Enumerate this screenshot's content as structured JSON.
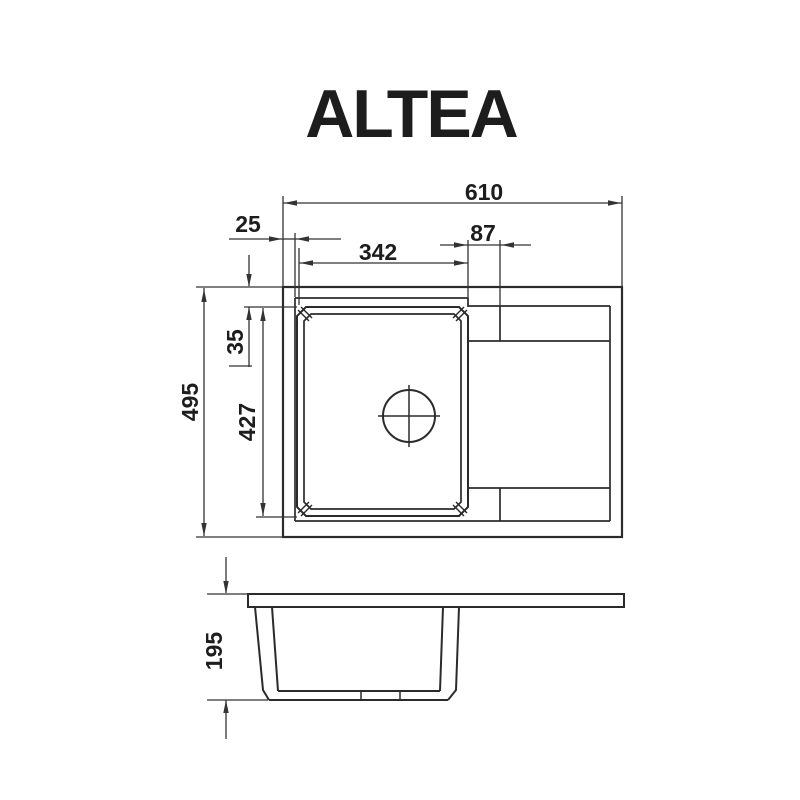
{
  "title": "ALTEA",
  "drawing": {
    "dimensions": {
      "overall_width": "610",
      "left_rim": "25",
      "bowl_width": "342",
      "drain_offset": "87",
      "overall_depth": "495",
      "bowl_top_inset": "35",
      "bowl_length": "427",
      "height": "195"
    },
    "colors": {
      "background": "#ffffff",
      "outline": "#2b2b2b",
      "dimension": "#333333",
      "text": "#1d1d1d"
    },
    "arrow": {
      "length": 13,
      "half_width": 2.7
    },
    "geometry": {
      "rects": [
        {
          "name": "sink-outline",
          "x": 283,
          "y": 287,
          "w": 339,
          "h": 250,
          "sw": 2.2
        },
        {
          "name": "worktop-slab-side",
          "x": 248,
          "y": 594,
          "w": 376,
          "h": 13,
          "sw": 2
        }
      ],
      "paths": [
        {
          "name": "bowl-rim-outer",
          "d": "M306,307 H459 L468,316 V507 L459,516 H306 L297,507 V316 Z",
          "sw": 2
        },
        {
          "name": "bowl-rim-inner",
          "d": "M311,314 H454 L461,321 V502 L454,509 H311 L304,502 V321 Z",
          "sw": 1.7
        },
        {
          "name": "side-left-wall-outer",
          "d": "M255,607 L263,690 L269,700",
          "sw": 2
        },
        {
          "name": "side-left-wall-inner",
          "d": "M272,607 L278,691",
          "sw": 2
        },
        {
          "name": "side-right-wall-outer",
          "d": "M459,607 L456,690 L448,700",
          "sw": 2
        },
        {
          "name": "side-right-wall-inner",
          "d": "M443,607 L440,691",
          "sw": 2
        }
      ],
      "lines": [
        {
          "name": "rim-inner-edge-left",
          "x1": 295,
          "y1": 298,
          "x2": 295,
          "y2": 521,
          "sw": 1.7
        },
        {
          "name": "rim-inner-edge-top",
          "x1": 295,
          "y1": 298,
          "x2": 468,
          "y2": 298,
          "sw": 1.7
        },
        {
          "name": "rim-inner-edge-bottom",
          "x1": 295,
          "y1": 521,
          "x2": 610,
          "y2": 521,
          "sw": 1.7
        },
        {
          "name": "recess-top-edge",
          "x1": 468,
          "y1": 306,
          "x2": 610,
          "y2": 306,
          "sw": 1.7
        },
        {
          "name": "recess-right-edge",
          "x1": 610,
          "y1": 306,
          "x2": 610,
          "y2": 521,
          "sw": 1.7
        },
        {
          "name": "recess-connector",
          "x1": 468,
          "y1": 298,
          "x2": 468,
          "y2": 307,
          "sw": 1.7
        },
        {
          "name": "recess-step-top",
          "x1": 468,
          "y1": 341,
          "x2": 610,
          "y2": 341,
          "sw": 1.7
        },
        {
          "name": "recess-step-bottom",
          "x1": 468,
          "y1": 488,
          "x2": 610,
          "y2": 488,
          "sw": 1.7
        },
        {
          "name": "recess-divider-top",
          "x1": 500,
          "y1": 306,
          "x2": 500,
          "y2": 341,
          "sw": 1.7
        },
        {
          "name": "recess-divider-bottom",
          "x1": 500,
          "y1": 488,
          "x2": 500,
          "y2": 521,
          "sw": 1.7
        },
        {
          "name": "bowl-corner-mitre",
          "x1": 298,
          "y1": 310,
          "x2": 309,
          "y2": 321,
          "sw": 1.4
        },
        {
          "name": "bowl-corner-mitre",
          "x1": 301,
          "y1": 307,
          "x2": 312,
          "y2": 318,
          "sw": 1.4
        },
        {
          "name": "bowl-corner-mitre",
          "x1": 467,
          "y1": 310,
          "x2": 456,
          "y2": 321,
          "sw": 1.4
        },
        {
          "name": "bowl-corner-mitre",
          "x1": 464,
          "y1": 307,
          "x2": 453,
          "y2": 318,
          "sw": 1.4
        },
        {
          "name": "bowl-corner-mitre",
          "x1": 309,
          "y1": 502,
          "x2": 298,
          "y2": 513,
          "sw": 1.4
        },
        {
          "name": "bowl-corner-mitre",
          "x1": 312,
          "y1": 505,
          "x2": 301,
          "y2": 516,
          "sw": 1.4
        },
        {
          "name": "bowl-corner-mitre",
          "x1": 456,
          "y1": 502,
          "x2": 467,
          "y2": 513,
          "sw": 1.4
        },
        {
          "name": "bowl-corner-mitre",
          "x1": 453,
          "y1": 505,
          "x2": 464,
          "y2": 516,
          "sw": 1.4
        },
        {
          "name": "drain-crosshair-h",
          "x1": 378,
          "y1": 416,
          "x2": 440,
          "y2": 416,
          "sw": 1.5
        },
        {
          "name": "drain-crosshair-v",
          "x1": 409,
          "y1": 385,
          "x2": 409,
          "y2": 447,
          "sw": 1.5
        },
        {
          "name": "side-bottom-inner",
          "x1": 278,
          "y1": 691,
          "x2": 440,
          "y2": 691,
          "sw": 2
        },
        {
          "name": "side-bottom-outer",
          "x1": 269,
          "y1": 700,
          "x2": 448,
          "y2": 700,
          "sw": 2
        },
        {
          "name": "side-bottom-tick",
          "x1": 361,
          "y1": 691,
          "x2": 361,
          "y2": 700,
          "sw": 1.5
        },
        {
          "name": "side-bottom-tick",
          "x1": 400,
          "y1": 691,
          "x2": 400,
          "y2": 700,
          "sw": 1.5
        },
        {
          "name": "ext-line",
          "x1": 283,
          "y1": 196,
          "x2": 283,
          "y2": 286,
          "sw": 1.3,
          "dim": true
        },
        {
          "name": "ext-line",
          "x1": 622,
          "y1": 196,
          "x2": 622,
          "y2": 286,
          "sw": 1.3,
          "dim": true
        },
        {
          "name": "ext-line",
          "x1": 196,
          "y1": 287,
          "x2": 282,
          "y2": 287,
          "sw": 1.3,
          "dim": true
        },
        {
          "name": "ext-line",
          "x1": 196,
          "y1": 537,
          "x2": 282,
          "y2": 537,
          "sw": 1.3,
          "dim": true
        },
        {
          "name": "ext-line",
          "x1": 295,
          "y1": 233,
          "x2": 295,
          "y2": 297,
          "sw": 1.3,
          "dim": true
        },
        {
          "name": "ext-line",
          "x1": 299,
          "y1": 248,
          "x2": 299,
          "y2": 305,
          "sw": 1.3,
          "dim": true
        },
        {
          "name": "ext-line",
          "x1": 468,
          "y1": 240,
          "x2": 468,
          "y2": 306,
          "sw": 1.3,
          "dim": true
        },
        {
          "name": "ext-line",
          "x1": 500,
          "y1": 240,
          "x2": 500,
          "y2": 306,
          "sw": 1.3,
          "dim": true
        },
        {
          "name": "ext-line",
          "x1": 244,
          "y1": 307,
          "x2": 297,
          "y2": 307,
          "sw": 1.3,
          "dim": true
        },
        {
          "name": "ext-line",
          "x1": 256,
          "y1": 517,
          "x2": 297,
          "y2": 517,
          "sw": 1.3,
          "dim": true
        },
        {
          "name": "ext-line",
          "x1": 207,
          "y1": 594,
          "x2": 247,
          "y2": 594,
          "sw": 1.3,
          "dim": true
        },
        {
          "name": "ext-line",
          "x1": 207,
          "y1": 700,
          "x2": 268,
          "y2": 700,
          "sw": 1.3,
          "dim": true
        },
        {
          "name": "dim-line-610",
          "x1": 283,
          "y1": 203,
          "x2": 622,
          "y2": 203,
          "sw": 1.3,
          "dim": true
        },
        {
          "name": "dim-line-25",
          "x1": 229,
          "y1": 239,
          "x2": 283,
          "y2": 239,
          "sw": 1.3,
          "dim": true
        },
        {
          "name": "dim-line-25",
          "x1": 283,
          "y1": 239,
          "x2": 295,
          "y2": 239,
          "sw": 1.3,
          "dim": true
        },
        {
          "name": "dim-line-25",
          "x1": 295,
          "y1": 239,
          "x2": 341,
          "y2": 239,
          "sw": 1.3,
          "dim": true
        },
        {
          "name": "dim-line-342",
          "x1": 299,
          "y1": 263,
          "x2": 468,
          "y2": 263,
          "sw": 1.3,
          "dim": true
        },
        {
          "name": "dim-line-87",
          "x1": 440,
          "y1": 245,
          "x2": 468,
          "y2": 245,
          "sw": 1.3,
          "dim": true
        },
        {
          "name": "dim-line-87",
          "x1": 468,
          "y1": 245,
          "x2": 500,
          "y2": 245,
          "sw": 1.3,
          "dim": true
        },
        {
          "name": "dim-line-87",
          "x1": 500,
          "y1": 245,
          "x2": 531,
          "y2": 245,
          "sw": 1.3,
          "dim": true
        },
        {
          "name": "dim-line-495",
          "x1": 204,
          "y1": 288,
          "x2": 204,
          "y2": 536,
          "sw": 1.3,
          "dim": true
        },
        {
          "name": "dim-line-35",
          "x1": 249,
          "y1": 255,
          "x2": 249,
          "y2": 286,
          "sw": 1.3,
          "dim": true
        },
        {
          "name": "dim-line-35",
          "x1": 249,
          "y1": 307,
          "x2": 249,
          "y2": 367,
          "sw": 1.3,
          "dim": true
        },
        {
          "name": "dim-tail-tick-35",
          "x1": 229,
          "y1": 366,
          "x2": 252,
          "y2": 366,
          "sw": 1.3,
          "dim": true
        },
        {
          "name": "dim-line-427",
          "x1": 263,
          "y1": 308,
          "x2": 263,
          "y2": 516,
          "sw": 1.3,
          "dim": true
        },
        {
          "name": "dim-line-195",
          "x1": 226,
          "y1": 557,
          "x2": 226,
          "y2": 593,
          "sw": 1.3,
          "dim": true
        },
        {
          "name": "dim-line-195",
          "x1": 226,
          "y1": 700,
          "x2": 226,
          "y2": 739,
          "sw": 1.3,
          "dim": true
        }
      ],
      "circles": [
        {
          "name": "drain-hole",
          "cx": 409,
          "cy": 416,
          "r": 26,
          "sw": 2
        }
      ],
      "arrows": [
        {
          "name": "arrow-610-left",
          "x": 284,
          "y": 203,
          "dir": 180
        },
        {
          "name": "arrow-610-right",
          "x": 621,
          "y": 203,
          "dir": 0
        },
        {
          "name": "arrow-25-left",
          "x": 282,
          "y": 239,
          "dir": 0
        },
        {
          "name": "arrow-25-right",
          "x": 296,
          "y": 239,
          "dir": 180
        },
        {
          "name": "arrow-342-left",
          "x": 300,
          "y": 263,
          "dir": 180
        },
        {
          "name": "arrow-342-right",
          "x": 467,
          "y": 263,
          "dir": 0
        },
        {
          "name": "arrow-87-left",
          "x": 467,
          "y": 245,
          "dir": 0
        },
        {
          "name": "arrow-87-right",
          "x": 501,
          "y": 245,
          "dir": 180
        },
        {
          "name": "arrow-495-top",
          "x": 204,
          "y": 289,
          "dir": 270
        },
        {
          "name": "arrow-495-bottom",
          "x": 204,
          "y": 536,
          "dir": 90
        },
        {
          "name": "arrow-35-top",
          "x": 249,
          "y": 287,
          "dir": 90
        },
        {
          "name": "arrow-35-bottom",
          "x": 249,
          "y": 307,
          "dir": 270
        },
        {
          "name": "arrow-427-top",
          "x": 263,
          "y": 308,
          "dir": 270
        },
        {
          "name": "arrow-427-bottom",
          "x": 263,
          "y": 516,
          "dir": 90
        },
        {
          "name": "arrow-195-top",
          "x": 226,
          "y": 594,
          "dir": 90
        },
        {
          "name": "arrow-195-bottom",
          "x": 226,
          "y": 700,
          "dir": 270
        }
      ],
      "labels": [
        {
          "key": "overall_width",
          "x": 484,
          "y": 192,
          "rot": 0
        },
        {
          "key": "left_rim",
          "x": 248,
          "y": 224,
          "rot": 0
        },
        {
          "key": "bowl_width",
          "x": 378,
          "y": 252,
          "rot": 0
        },
        {
          "key": "drain_offset",
          "x": 483,
          "y": 233,
          "rot": 0
        },
        {
          "key": "overall_depth",
          "x": 190,
          "y": 402,
          "rot": -90
        },
        {
          "key": "bowl_top_inset",
          "x": 235,
          "y": 342,
          "rot": -90
        },
        {
          "key": "bowl_length",
          "x": 247,
          "y": 422,
          "rot": -90
        },
        {
          "key": "height",
          "x": 214,
          "y": 651,
          "rot": -90
        }
      ]
    }
  }
}
